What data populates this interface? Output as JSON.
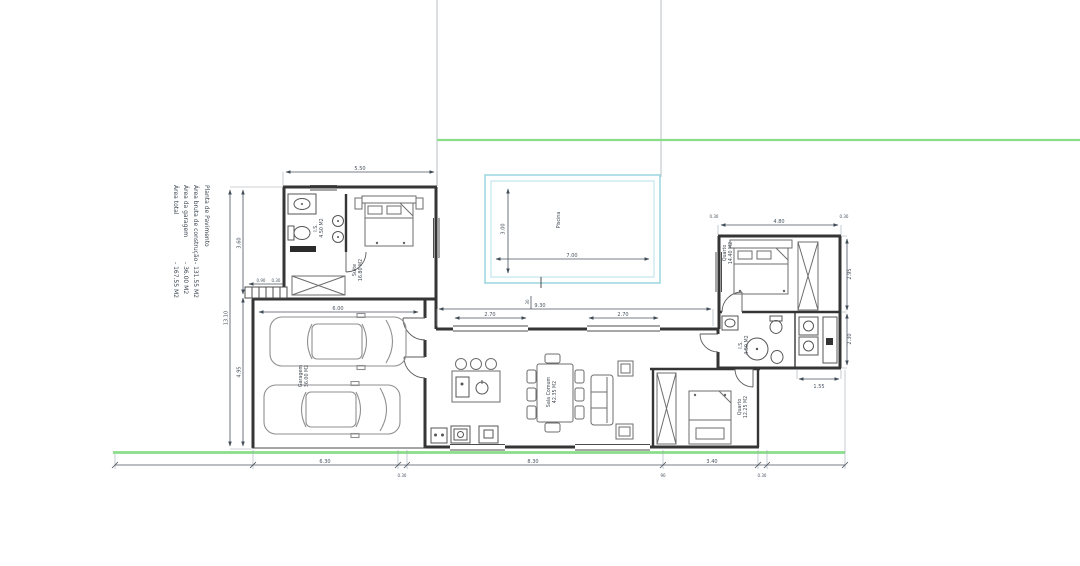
{
  "colors": {
    "wall": "#353535",
    "dimension": "#4a5460",
    "pool_outline": "#9fd8e0",
    "pool_inner": "#b5e2e8",
    "site_green": "#8ade8a",
    "site_boundary": "#aab2b8"
  },
  "title_block": {
    "title": "Planta de Pavimento",
    "items": [
      {
        "label": "Área bruta de construção",
        "value": "- 131.55 M2"
      },
      {
        "label": "Área da garagem",
        "value": "- 36.00 M2"
      },
      {
        "label": "Área total",
        "value": "- 167.55 M2"
      }
    ]
  },
  "rooms": {
    "is1": {
      "name": "I.S.",
      "area": "4.50 M2"
    },
    "suite": {
      "name": "Suite",
      "area": "16.80 M2"
    },
    "piscina": {
      "name": "Piscina",
      "area": ""
    },
    "quarto1": {
      "name": "Quarto",
      "area": "14.40 M2"
    },
    "is2": {
      "name": "I.S.",
      "area": "4.50 M2"
    },
    "garagem": {
      "name": "Garagem",
      "area": "36.00 M2"
    },
    "sala": {
      "name": "Sala Comum",
      "area": "42.35 M2"
    },
    "quarto2": {
      "name": "Quarto",
      "area": "12.25 M2"
    }
  },
  "dims": {
    "suite_top": "5.50",
    "left_total": "13.10",
    "left_upper": "3.60",
    "left_lower": "4.95",
    "porch_a": "0.90",
    "porch_b": "0.30",
    "pool_h": "3.00",
    "pool_w": "7.00",
    "garage_w": "6.00",
    "wing_top": "4.80",
    "wing_off_l": "0.30",
    "wing_off_r": "0.30",
    "mid_total": "9.30",
    "mid_win1": "2.70",
    "mid_win2": "2.70",
    "mid_wall": "30",
    "right_seg1": "2.95",
    "right_seg2": "2.30",
    "right_bottom": "1.55",
    "bottom_1": "6.30",
    "bottom_2": "0.30",
    "bottom_3": "8.30",
    "bottom_4": "90",
    "bottom_5": "3.40",
    "bottom_6": "0.30"
  }
}
